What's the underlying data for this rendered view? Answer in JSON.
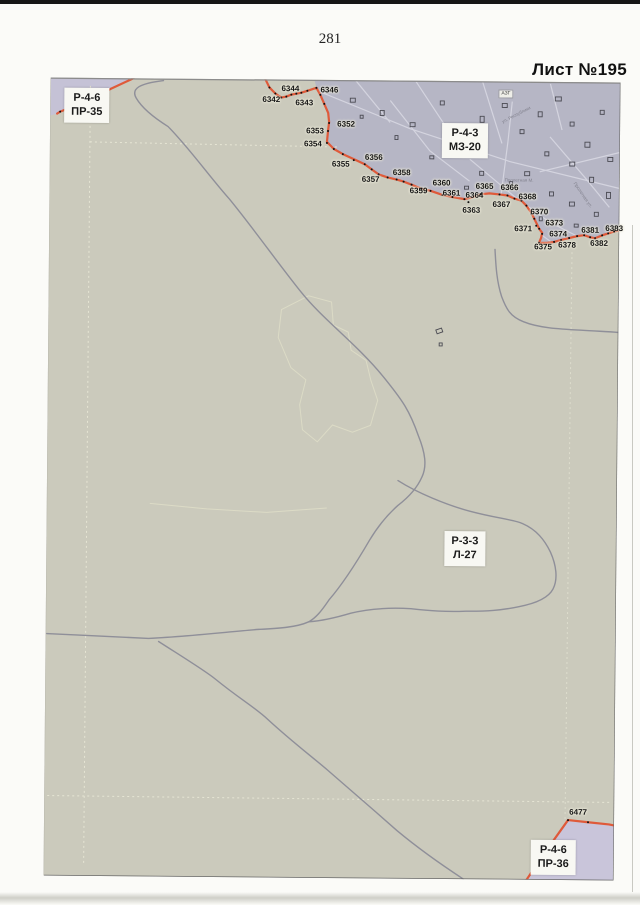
{
  "page": {
    "number": "281",
    "sheet_title": "Лист №195"
  },
  "zones": [
    {
      "line1": "Р-4-6",
      "line2": "ПР-35"
    },
    {
      "line1": "Р-4-3",
      "line2": "МЗ-20"
    },
    {
      "line1": "Р-3-3",
      "line2": "Л-27"
    },
    {
      "line1": "Р-4-6",
      "line2": "ПР-36"
    }
  ],
  "map": {
    "azs_label": "АЗГ",
    "colors": {
      "land": "#cbcabc",
      "urban": "#b6b6c5",
      "urban_corner": "#c5c2d6",
      "zone_pr36": "#c9c5da",
      "boundary_red": "#df5a3a",
      "road_gray": "#8f8f99"
    },
    "streets": [
      {
        "name": "ул. Республики",
        "x": 452,
        "y": 38,
        "angle": -28
      },
      {
        "name": "Пролетная М.",
        "x": 455,
        "y": 96,
        "angle": 0
      },
      {
        "name": "Пролетная ул.",
        "x": 525,
        "y": 98,
        "angle": 55
      }
    ],
    "points": [
      {
        "label": "6342",
        "dx": 231,
        "dy": 18,
        "lx": 221,
        "ly": 20
      },
      {
        "label": "6344",
        "dx": 241,
        "dy": 15,
        "lx": 240,
        "ly": 9
      },
      {
        "label": "6343",
        "dx": 251,
        "dy": 13,
        "lx": 254,
        "ly": 23
      },
      {
        "label": "6346",
        "dx": 266,
        "dy": 8,
        "lx": 279,
        "ly": 10
      },
      {
        "label": "6352",
        "dx": 279,
        "dy": 43,
        "lx": 296,
        "ly": 44
      },
      {
        "label": "6353",
        "dx": 278,
        "dy": 51,
        "lx": 265,
        "ly": 51
      },
      {
        "label": "6354",
        "dx": 277,
        "dy": 63,
        "lx": 263,
        "ly": 64
      },
      {
        "label": "6355",
        "dx": 304,
        "dy": 80,
        "lx": 291,
        "ly": 84
      },
      {
        "label": "6356",
        "dx": 315,
        "dy": 84,
        "lx": 324,
        "ly": 77
      },
      {
        "label": "6357",
        "dx": 329,
        "dy": 94,
        "lx": 321,
        "ly": 99
      },
      {
        "label": "6358",
        "dx": 347,
        "dy": 99,
        "lx": 352,
        "ly": 92
      },
      {
        "label": "6359",
        "dx": 362,
        "dy": 104,
        "lx": 369,
        "ly": 110
      },
      {
        "label": "6360",
        "dx": 381,
        "dy": 110,
        "lx": 392,
        "ly": 102
      },
      {
        "label": "6361",
        "dx": 393,
        "dy": 114,
        "lx": 402,
        "ly": 112
      },
      {
        "label": "6363",
        "dx": 419,
        "dy": 121,
        "lx": 422,
        "ly": 129
      },
      {
        "label": "6364",
        "dx": 415,
        "dy": 118,
        "lx": 425,
        "ly": 114
      },
      {
        "label": "6365",
        "dx": 431,
        "dy": 113,
        "lx": 435,
        "ly": 105
      },
      {
        "label": "6366",
        "dx": 450,
        "dy": 113,
        "lx": 460,
        "ly": 106
      },
      {
        "label": "6367",
        "dx": 465,
        "dy": 117,
        "lx": 452,
        "ly": 123
      },
      {
        "label": "6368",
        "dx": 472,
        "dy": 119,
        "lx": 478,
        "ly": 115
      },
      {
        "label": "6370",
        "dx": 482,
        "dy": 132,
        "lx": 490,
        "ly": 130
      },
      {
        "label": "6371",
        "dx": 487,
        "dy": 144,
        "lx": 474,
        "ly": 147
      },
      {
        "label": "6373",
        "dx": 490,
        "dy": 147,
        "lx": 505,
        "ly": 141
      },
      {
        "label": "6374",
        "dx": 493,
        "dy": 152,
        "lx": 509,
        "ly": 152
      },
      {
        "label": "6375",
        "dx": 490,
        "dy": 161,
        "lx": 494,
        "ly": 165
      },
      {
        "label": "6378",
        "dx": 512,
        "dy": 158,
        "lx": 518,
        "ly": 163
      },
      {
        "label": "6381",
        "dx": 535,
        "dy": 153,
        "lx": 541,
        "ly": 148
      },
      {
        "label": "6382",
        "dx": 546,
        "dy": 156,
        "lx": 550,
        "ly": 161
      },
      {
        "label": "6383",
        "dx": 559,
        "dy": 151,
        "lx": 565,
        "ly": 146
      },
      {
        "label": "6477",
        "dx": 524,
        "dy": 738,
        "lx": 534,
        "ly": 730
      }
    ],
    "extra_dots": [
      [
        219,
        8
      ],
      [
        225,
        14
      ],
      [
        236,
        17
      ],
      [
        246,
        14
      ],
      [
        257,
        11
      ],
      [
        270,
        15
      ],
      [
        274,
        24
      ],
      [
        284,
        69
      ],
      [
        293,
        74
      ],
      [
        322,
        89
      ],
      [
        338,
        97
      ],
      [
        354,
        101
      ],
      [
        372,
        108
      ],
      [
        403,
        116
      ],
      [
        458,
        114
      ],
      [
        477,
        124
      ],
      [
        485,
        137
      ],
      [
        505,
        160
      ],
      [
        520,
        156
      ],
      [
        528,
        154
      ],
      [
        541,
        155
      ],
      [
        553,
        153
      ],
      [
        565,
        149
      ],
      [
        10,
        34
      ],
      [
        544,
        740
      ]
    ]
  }
}
